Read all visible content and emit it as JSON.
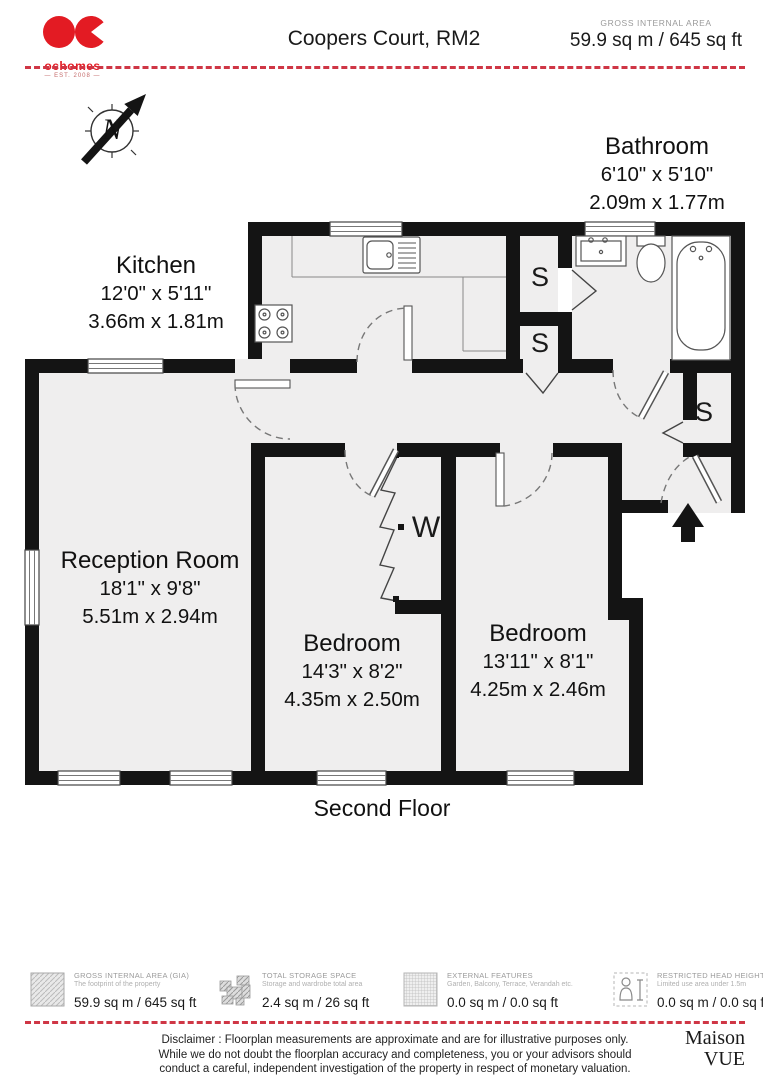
{
  "header": {
    "logo": {
      "brand": "ochomes",
      "est": "— EST. 2008 —"
    },
    "title": "Coopers Court, RM2",
    "area_label": "GROSS INTERNAL AREA",
    "area_value": "59.9 sq m / 645 sq ft"
  },
  "compass": {
    "north": "N"
  },
  "floorplan": {
    "floor_label": "Second Floor",
    "rooms": {
      "kitchen": {
        "name": "Kitchen",
        "imperial": "12'0\" x 5'11\"",
        "metric": "3.66m x 1.81m"
      },
      "bathroom": {
        "name": "Bathroom",
        "imperial": "6'10\" x 5'10\"",
        "metric": "2.09m x 1.77m"
      },
      "reception": {
        "name": "Reception Room",
        "imperial": "18'1\" x 9'8\"",
        "metric": "5.51m x 2.94m"
      },
      "bedroom1": {
        "name": "Bedroom",
        "imperial": "14'3\" x 8'2\"",
        "metric": "4.35m x 2.50m"
      },
      "bedroom2": {
        "name": "Bedroom",
        "imperial": "13'11\" x 8'1\"",
        "metric": "4.25m x 2.46m"
      }
    },
    "markers": {
      "storage1": "S",
      "storage2": "S",
      "storage3": "S",
      "wardrobe": "W"
    }
  },
  "legend": {
    "items": [
      {
        "icon": "gia-hatch-icon",
        "title": "GROSS INTERNAL AREA (GIA)",
        "subtitle": "The footprint of the property",
        "value": "59.9 sq m / 645 sq ft"
      },
      {
        "icon": "storage-hatch-icon",
        "title": "TOTAL STORAGE SPACE",
        "subtitle": "Storage and wardrobe total area",
        "value": "2.4 sq m / 26 sq ft"
      },
      {
        "icon": "external-grid-icon",
        "title": "EXTERNAL FEATURES",
        "subtitle": "Garden, Balcony, Terrace, Verandah etc.",
        "value": "0.0 sq m / 0.0 sq ft"
      },
      {
        "icon": "head-height-person-icon",
        "title": "RESTRICTED HEAD HEIGHT",
        "subtitle": "Limited use area under 1.5m",
        "value": "0.0 sq m / 0.0 sq ft"
      }
    ]
  },
  "disclaimer": {
    "line1": "Disclaimer : Floorplan measurements are approximate and are for illustrative purposes only.",
    "line2": "While we do not doubt the floorplan accuracy and completeness, you or your advisors should",
    "line3": "conduct a careful, independent investigation of the property in respect of monetary valuation."
  },
  "footer_brand": {
    "line1": "Maison",
    "line2": "VUE"
  },
  "colors": {
    "brand_red": "#e31b23",
    "dash_red": "#cf3645",
    "wall_black": "#141414",
    "floor_grey": "#efeeee"
  }
}
